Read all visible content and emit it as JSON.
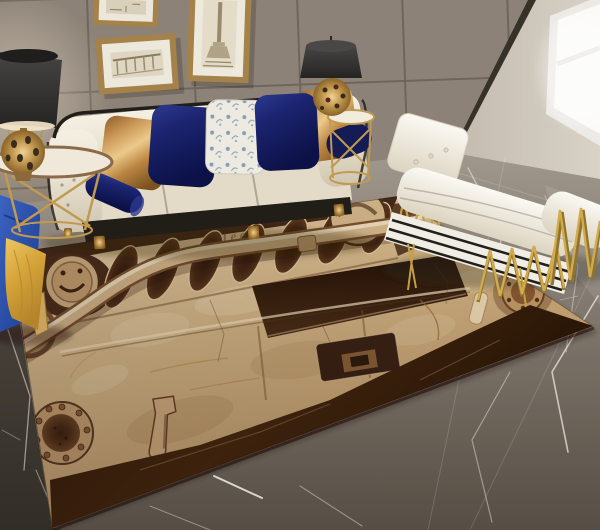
{
  "scene": {
    "title": "Jeep front-grille area rug in a modern living room",
    "setting": "modern living room lifestyle photo",
    "flooring": "dark grey marble tile floor",
    "wall": "taupe panelled feature wall with dark corner trim and bright window"
  },
  "rug": {
    "brand_text": "Jeep",
    "theme": "vintage Jeep front end printed on tan marbled area rug",
    "elements": [
      "seven-slot grille",
      "tube bumper bar",
      "round smiley headlight",
      "round headlight",
      "riveted fog lamp",
      "tow hook",
      "fuel filler cap",
      "license plate recess",
      "dark marbled border"
    ]
  },
  "furniture": {
    "sofa": "cream tufted three-seat sofa with black piping and gold feet",
    "pillows": [
      "gold satin pillow",
      "navy velvet pillow",
      "white-blue floral pillow",
      "navy velvet pillow",
      "gold satin pillow",
      "navy bolster left",
      "navy bolster right"
    ],
    "daybed": "white tufted daybed with gold zigzag wire frame and striped base",
    "blue_chair": "royal blue velvet chair with gold throw blanket",
    "side_table_left": "round side table with gold cross legs",
    "side_table_right": "tall round gold wire side table",
    "lamp_left": "charcoal drum-shade lamp with pierced gold base",
    "lamp_right": "charcoal drum-shade lamp with pierced gold base"
  },
  "wall_art": {
    "frame_small": "small framed architectural sketch",
    "frame_gate": "framed Brandenburg Gate sketch",
    "frame_column": "framed victory column sketch"
  },
  "colors": {
    "wall_tile": "#978d81",
    "grout": "#766c61",
    "corner_trim": "#363229",
    "right_wall": "#cfc8bc",
    "window": "#fbfaf7",
    "floor_light": "#a39d94",
    "floor_dark": "#514b44",
    "marble_dark": "#3b352e",
    "vein": "#e4e1db",
    "sofa_cream": "#e9e2d1",
    "sofa_trim": "#211d17",
    "pillow_gold": "#c89454",
    "pillow_navy": "#1b2470",
    "floral_white": "#edeae1",
    "gold_metal": "#c69d55",
    "lamp_shade": "#34322f",
    "chaise_white": "#f3f0e8",
    "chaise_stripe": "#23201b",
    "blue_chair": "#2b50a8",
    "throw_gold": "#d3a238",
    "rug_tan": "#d9bb8c",
    "rug_brown": "#3a2112"
  }
}
